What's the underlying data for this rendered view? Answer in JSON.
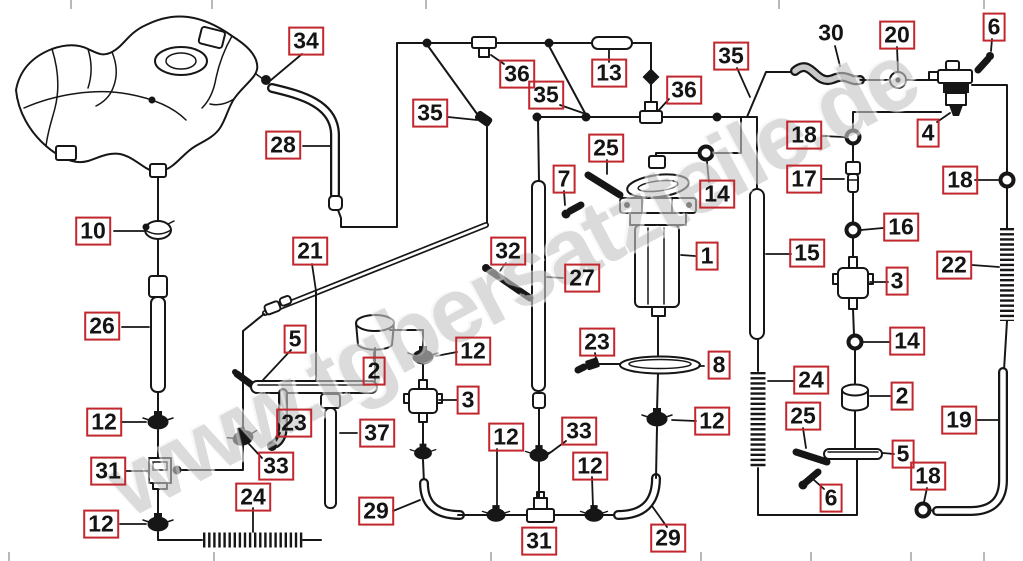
{
  "watermark": {
    "text": "www.tgbersatzteile.de"
  },
  "colors": {
    "callout_border": "#c1272d",
    "callout_text": "#141414",
    "line": "#161616",
    "watermark": "#c6c6c6",
    "background": "#ffffff"
  },
  "callouts": [
    {
      "label": "34",
      "x": 306,
      "y": 41,
      "boxed": true
    },
    {
      "label": "6",
      "x": 994,
      "y": 27,
      "boxed": true
    },
    {
      "label": "20",
      "x": 897,
      "y": 35,
      "boxed": true
    },
    {
      "label": "30",
      "x": 831,
      "y": 33,
      "boxed": false
    },
    {
      "label": "35",
      "x": 731,
      "y": 56,
      "boxed": true
    },
    {
      "label": "13",
      "x": 609,
      "y": 73,
      "boxed": true
    },
    {
      "label": "36",
      "x": 684,
      "y": 90,
      "boxed": true
    },
    {
      "label": "36",
      "x": 517,
      "y": 74,
      "boxed": true
    },
    {
      "label": "35",
      "x": 430,
      "y": 113,
      "boxed": true
    },
    {
      "label": "35",
      "x": 546,
      "y": 95,
      "boxed": true
    },
    {
      "label": "28",
      "x": 283,
      "y": 145,
      "boxed": true
    },
    {
      "label": "4",
      "x": 928,
      "y": 133,
      "boxed": true
    },
    {
      "label": "18",
      "x": 804,
      "y": 135,
      "boxed": true
    },
    {
      "label": "18",
      "x": 960,
      "y": 180,
      "boxed": true
    },
    {
      "label": "17",
      "x": 804,
      "y": 179,
      "boxed": true
    },
    {
      "label": "25",
      "x": 606,
      "y": 148,
      "boxed": true
    },
    {
      "label": "7",
      "x": 564,
      "y": 179,
      "boxed": true
    },
    {
      "label": "14",
      "x": 717,
      "y": 194,
      "boxed": true
    },
    {
      "label": "10",
      "x": 93,
      "y": 231,
      "boxed": true
    },
    {
      "label": "16",
      "x": 901,
      "y": 227,
      "boxed": true
    },
    {
      "label": "21",
      "x": 310,
      "y": 251,
      "boxed": true
    },
    {
      "label": "15",
      "x": 807,
      "y": 253,
      "boxed": true
    },
    {
      "label": "22",
      "x": 954,
      "y": 265,
      "boxed": true
    },
    {
      "label": "1",
      "x": 707,
      "y": 256,
      "boxed": true
    },
    {
      "label": "32",
      "x": 508,
      "y": 251,
      "boxed": true
    },
    {
      "label": "27",
      "x": 582,
      "y": 278,
      "boxed": true
    },
    {
      "label": "3",
      "x": 897,
      "y": 281,
      "boxed": true
    },
    {
      "label": "26",
      "x": 102,
      "y": 326,
      "boxed": true
    },
    {
      "label": "5",
      "x": 295,
      "y": 339,
      "boxed": true
    },
    {
      "label": "23",
      "x": 597,
      "y": 342,
      "boxed": true
    },
    {
      "label": "14",
      "x": 907,
      "y": 341,
      "boxed": true
    },
    {
      "label": "12",
      "x": 473,
      "y": 351,
      "boxed": true
    },
    {
      "label": "8",
      "x": 719,
      "y": 365,
      "boxed": true
    },
    {
      "label": "2",
      "x": 374,
      "y": 371,
      "boxed": true
    },
    {
      "label": "24",
      "x": 811,
      "y": 380,
      "boxed": true
    },
    {
      "label": "2",
      "x": 902,
      "y": 396,
      "boxed": true
    },
    {
      "label": "3",
      "x": 468,
      "y": 400,
      "boxed": true
    },
    {
      "label": "25",
      "x": 803,
      "y": 416,
      "boxed": true
    },
    {
      "label": "19",
      "x": 959,
      "y": 420,
      "boxed": true
    },
    {
      "label": "12",
      "x": 104,
      "y": 422,
      "boxed": true
    },
    {
      "label": "23",
      "x": 294,
      "y": 423,
      "boxed": true
    },
    {
      "label": "12",
      "x": 712,
      "y": 421,
      "boxed": true
    },
    {
      "label": "33",
      "x": 579,
      "y": 431,
      "boxed": true
    },
    {
      "label": "37",
      "x": 377,
      "y": 433,
      "boxed": true
    },
    {
      "label": "12",
      "x": 506,
      "y": 437,
      "boxed": true
    },
    {
      "label": "5",
      "x": 903,
      "y": 454,
      "boxed": true
    },
    {
      "label": "33",
      "x": 276,
      "y": 466,
      "boxed": true
    },
    {
      "label": "12",
      "x": 590,
      "y": 466,
      "boxed": true
    },
    {
      "label": "31",
      "x": 108,
      "y": 471,
      "boxed": true
    },
    {
      "label": "18",
      "x": 928,
      "y": 476,
      "boxed": true
    },
    {
      "label": "24",
      "x": 253,
      "y": 497,
      "boxed": true
    },
    {
      "label": "6",
      "x": 831,
      "y": 498,
      "boxed": true
    },
    {
      "label": "29",
      "x": 376,
      "y": 511,
      "boxed": true
    },
    {
      "label": "12",
      "x": 101,
      "y": 524,
      "boxed": true
    },
    {
      "label": "29",
      "x": 668,
      "y": 538,
      "boxed": true
    },
    {
      "label": "31",
      "x": 539,
      "y": 541,
      "boxed": true
    }
  ],
  "ticks": {
    "top": [
      70,
      211,
      425,
      778,
      983
    ],
    "bottom": [
      8,
      213,
      490,
      700,
      810,
      910,
      983
    ]
  }
}
